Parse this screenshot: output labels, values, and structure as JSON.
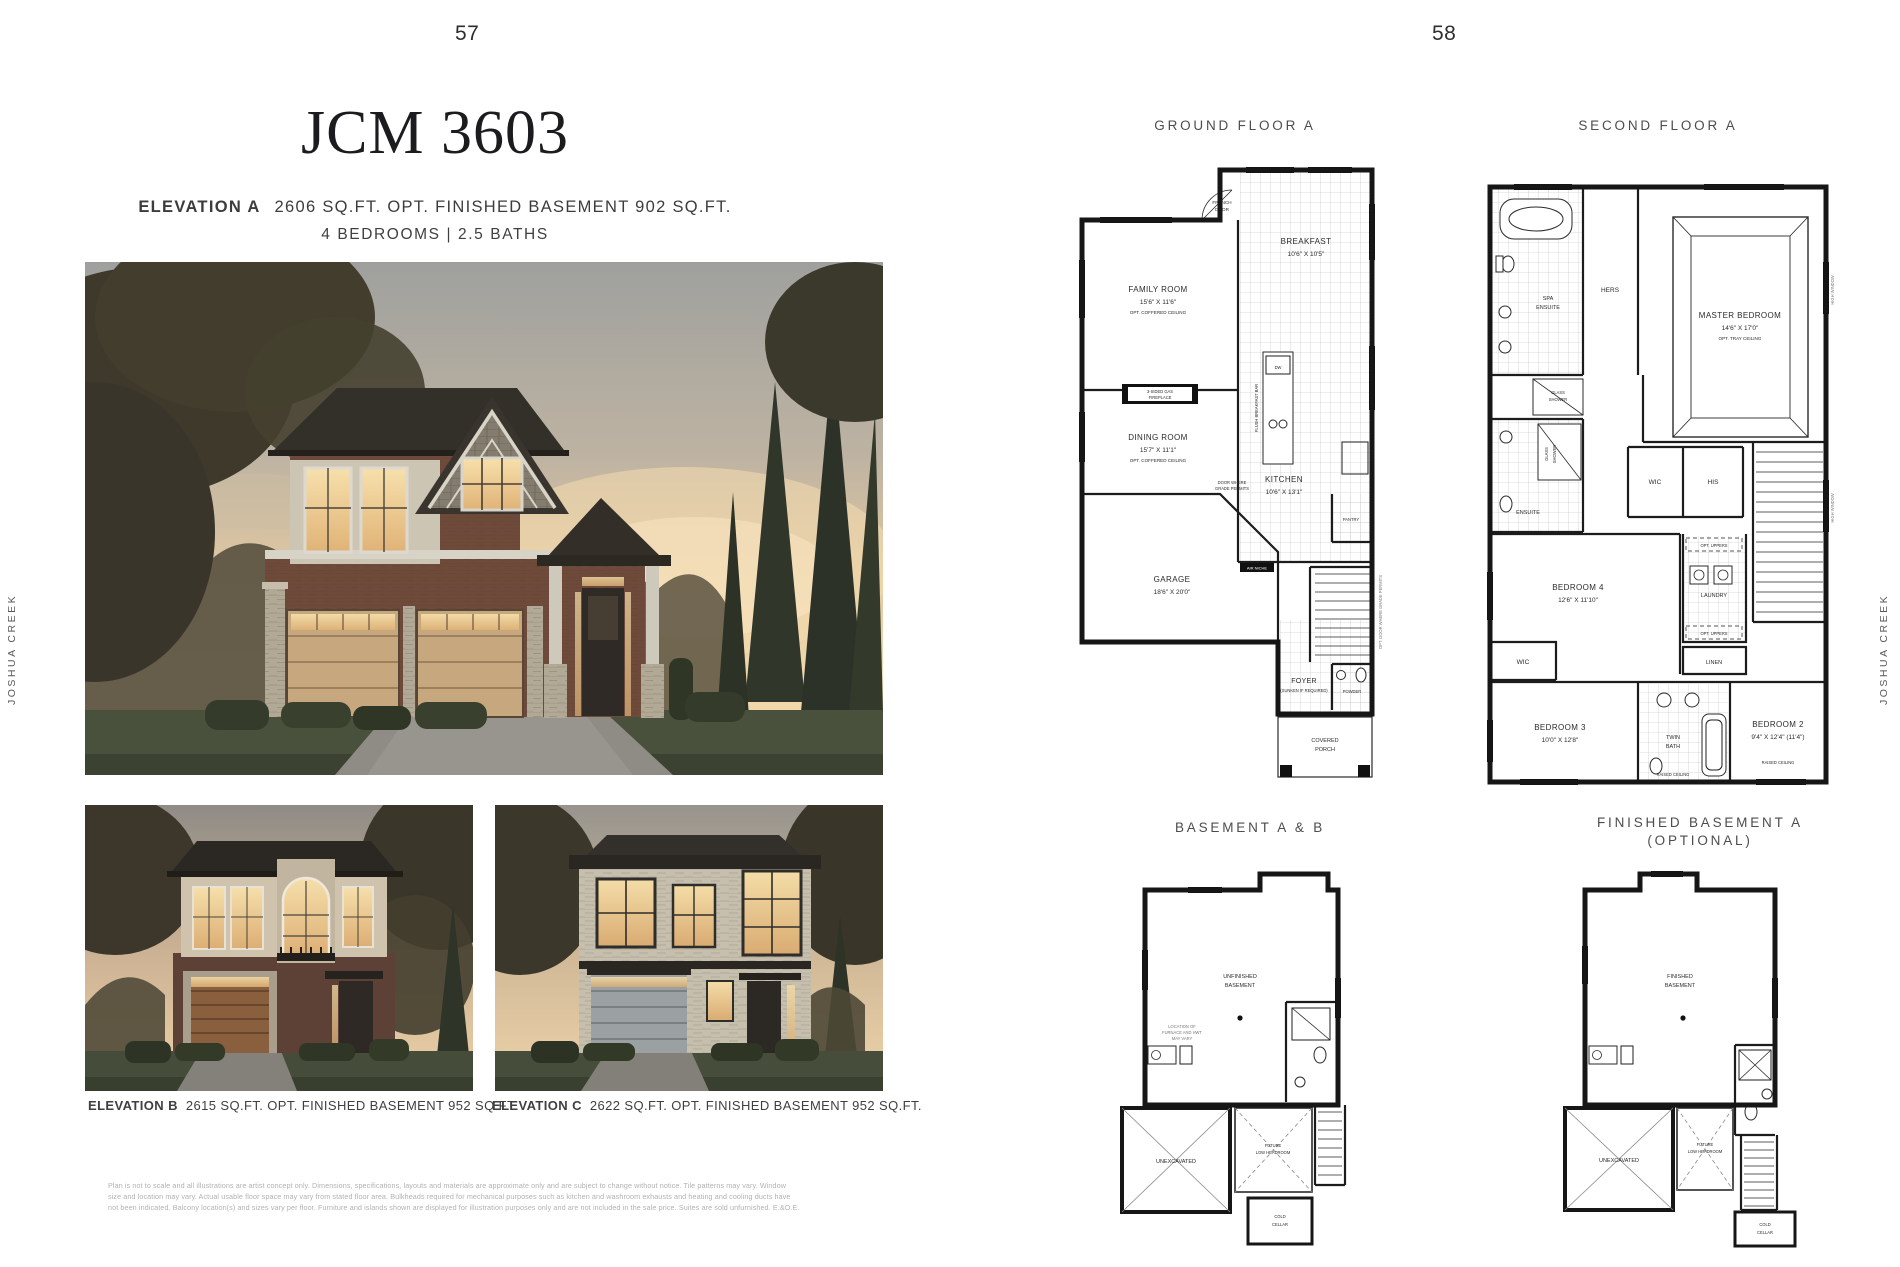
{
  "page": {
    "left_number": "57",
    "right_number": "58"
  },
  "side_label": "JOSHUA CREEK",
  "left_page": {
    "title": "JCM 3603",
    "elevation_a_label": "ELEVATION A",
    "elevation_a_specs": "2606 SQ.FT.  OPT. FINISHED BASEMENT 902 SQ.FT.",
    "bed_bath": "4 BEDROOMS  |  2.5 BATHS",
    "elevation_b_label": "ELEVATION B",
    "elevation_b_specs": "2615 SQ.FT.  OPT. FINISHED BASEMENT 952 SQ.FT.",
    "elevation_c_label": "ELEVATION C",
    "elevation_c_specs": "2622 SQ.FT.  OPT. FINISHED BASEMENT 952 SQ.FT.",
    "disclaimer": [
      "Plan is not to scale and all illustrations are artist concept only. Dimensions, specifications, layouts and materials are approximate only and are subject to change without notice. Tile patterns may vary. Window",
      "size and location may vary. Actual usable floor space may vary from stated floor area. Bulkheads required for mechanical purposes such as kitchen and washroom exhausts and heating and cooling ducts have",
      "not been indicated. Balcony location(s) and sizes vary per floor. Furniture and islands shown are displayed for illustration purposes only and are not included in the sale price. Suites are sold unfurnished. E.&O.E."
    ]
  },
  "ground_floor": {
    "title": "GROUND FLOOR A",
    "family_room": {
      "name": "FAMILY ROOM",
      "dims": "15'6\" X 11'6\"",
      "note": "OPT. COFFERED CEILING"
    },
    "dining_room": {
      "name": "DINING ROOM",
      "dims": "15'7\" X 11'1\"",
      "note": "OPT. COFFERED CEILING"
    },
    "breakfast": {
      "name": "BREAKFAST",
      "dims": "10'6\" X 10'5\""
    },
    "kitchen": {
      "name": "KITCHEN",
      "dims": "10'6\" X 13'1\""
    },
    "garage": {
      "name": "GARAGE",
      "dims": "18'6\" X 20'0\""
    },
    "foyer": {
      "name": "FOYER",
      "note": "(SUNKEN IF REQUIRED)"
    },
    "powder": "POWDER",
    "pantry": "PANTRY",
    "covered_porch_1": "COVERED",
    "covered_porch_2": "PORCH",
    "french_door_1": "FRENCH",
    "french_door_2": "DOOR",
    "fireplace_1": "3-SIDED GAS",
    "fireplace_2": "FIREPLACE",
    "breakfast_bar": "FLUSH  BREAKFAST BAR",
    "dw": "DW",
    "air_niche": "AIR NICHE",
    "door_note_1": "DOOR WHERE",
    "door_note_2": "GRADE PERMITS",
    "opt_door_note": "OPT. DOOR WHERE GRADE PERMITS"
  },
  "second_floor": {
    "title": "SECOND FLOOR A",
    "master": {
      "name": "MASTER BEDROOM",
      "dims": "14'6\" X 17'0\"",
      "note": "OPT. TRAY CEILING"
    },
    "spa_ensuite_1": "SPA",
    "spa_ensuite_2": "ENSUITE",
    "hers": "HERS",
    "his": "HIS",
    "wic": "WIC",
    "glass_shower_1": "GLASS",
    "glass_shower_2": "SHOWER",
    "ensuite": "ENSUITE",
    "bedroom4": {
      "name": "BEDROOM 4",
      "dims": "12'6\" X 11'10\""
    },
    "bedroom3": {
      "name": "BEDROOM 3",
      "dims": "10'0\" X 12'8\""
    },
    "bedroom2": {
      "name": "BEDROOM 2",
      "dims": "9'4\" X 12'4\" (11'4\")"
    },
    "twin_bath_1": "TWIN",
    "twin_bath_2": "BATH",
    "laundry": "LAUNDRY",
    "linen": "LINEN",
    "opt_uppers": "OPT. UPPERS",
    "raised_ceiling": "RAISED CEILING",
    "high_window": "HIGH WINDOW"
  },
  "basement": {
    "title": "BASEMENT A & B",
    "unfinished_1": "UNFINISHED",
    "unfinished_2": "BASEMENT",
    "unexcavated": "UNEXCAVATED",
    "future_low_1": "FUTURE",
    "future_low_2": "LOW HEADROOM",
    "cold_cellar_1": "COLD",
    "cold_cellar_2": "CELLAR",
    "furnace_note_1": "LOCATION OF",
    "furnace_note_2": "FURNACE AND HWT",
    "furnace_note_3": "MAY VARY"
  },
  "finished_basement": {
    "title_1": "FINISHED BASEMENT A",
    "title_2": "(OPTIONAL)",
    "finished_1": "FINISHED",
    "finished_2": "BASEMENT",
    "unexcavated": "UNEXCAVATED",
    "future_low_1": "FUTURE",
    "future_low_2": "LOW HEADROOM",
    "cold_cellar_1": "COLD",
    "cold_cellar_2": "CELLAR"
  }
}
